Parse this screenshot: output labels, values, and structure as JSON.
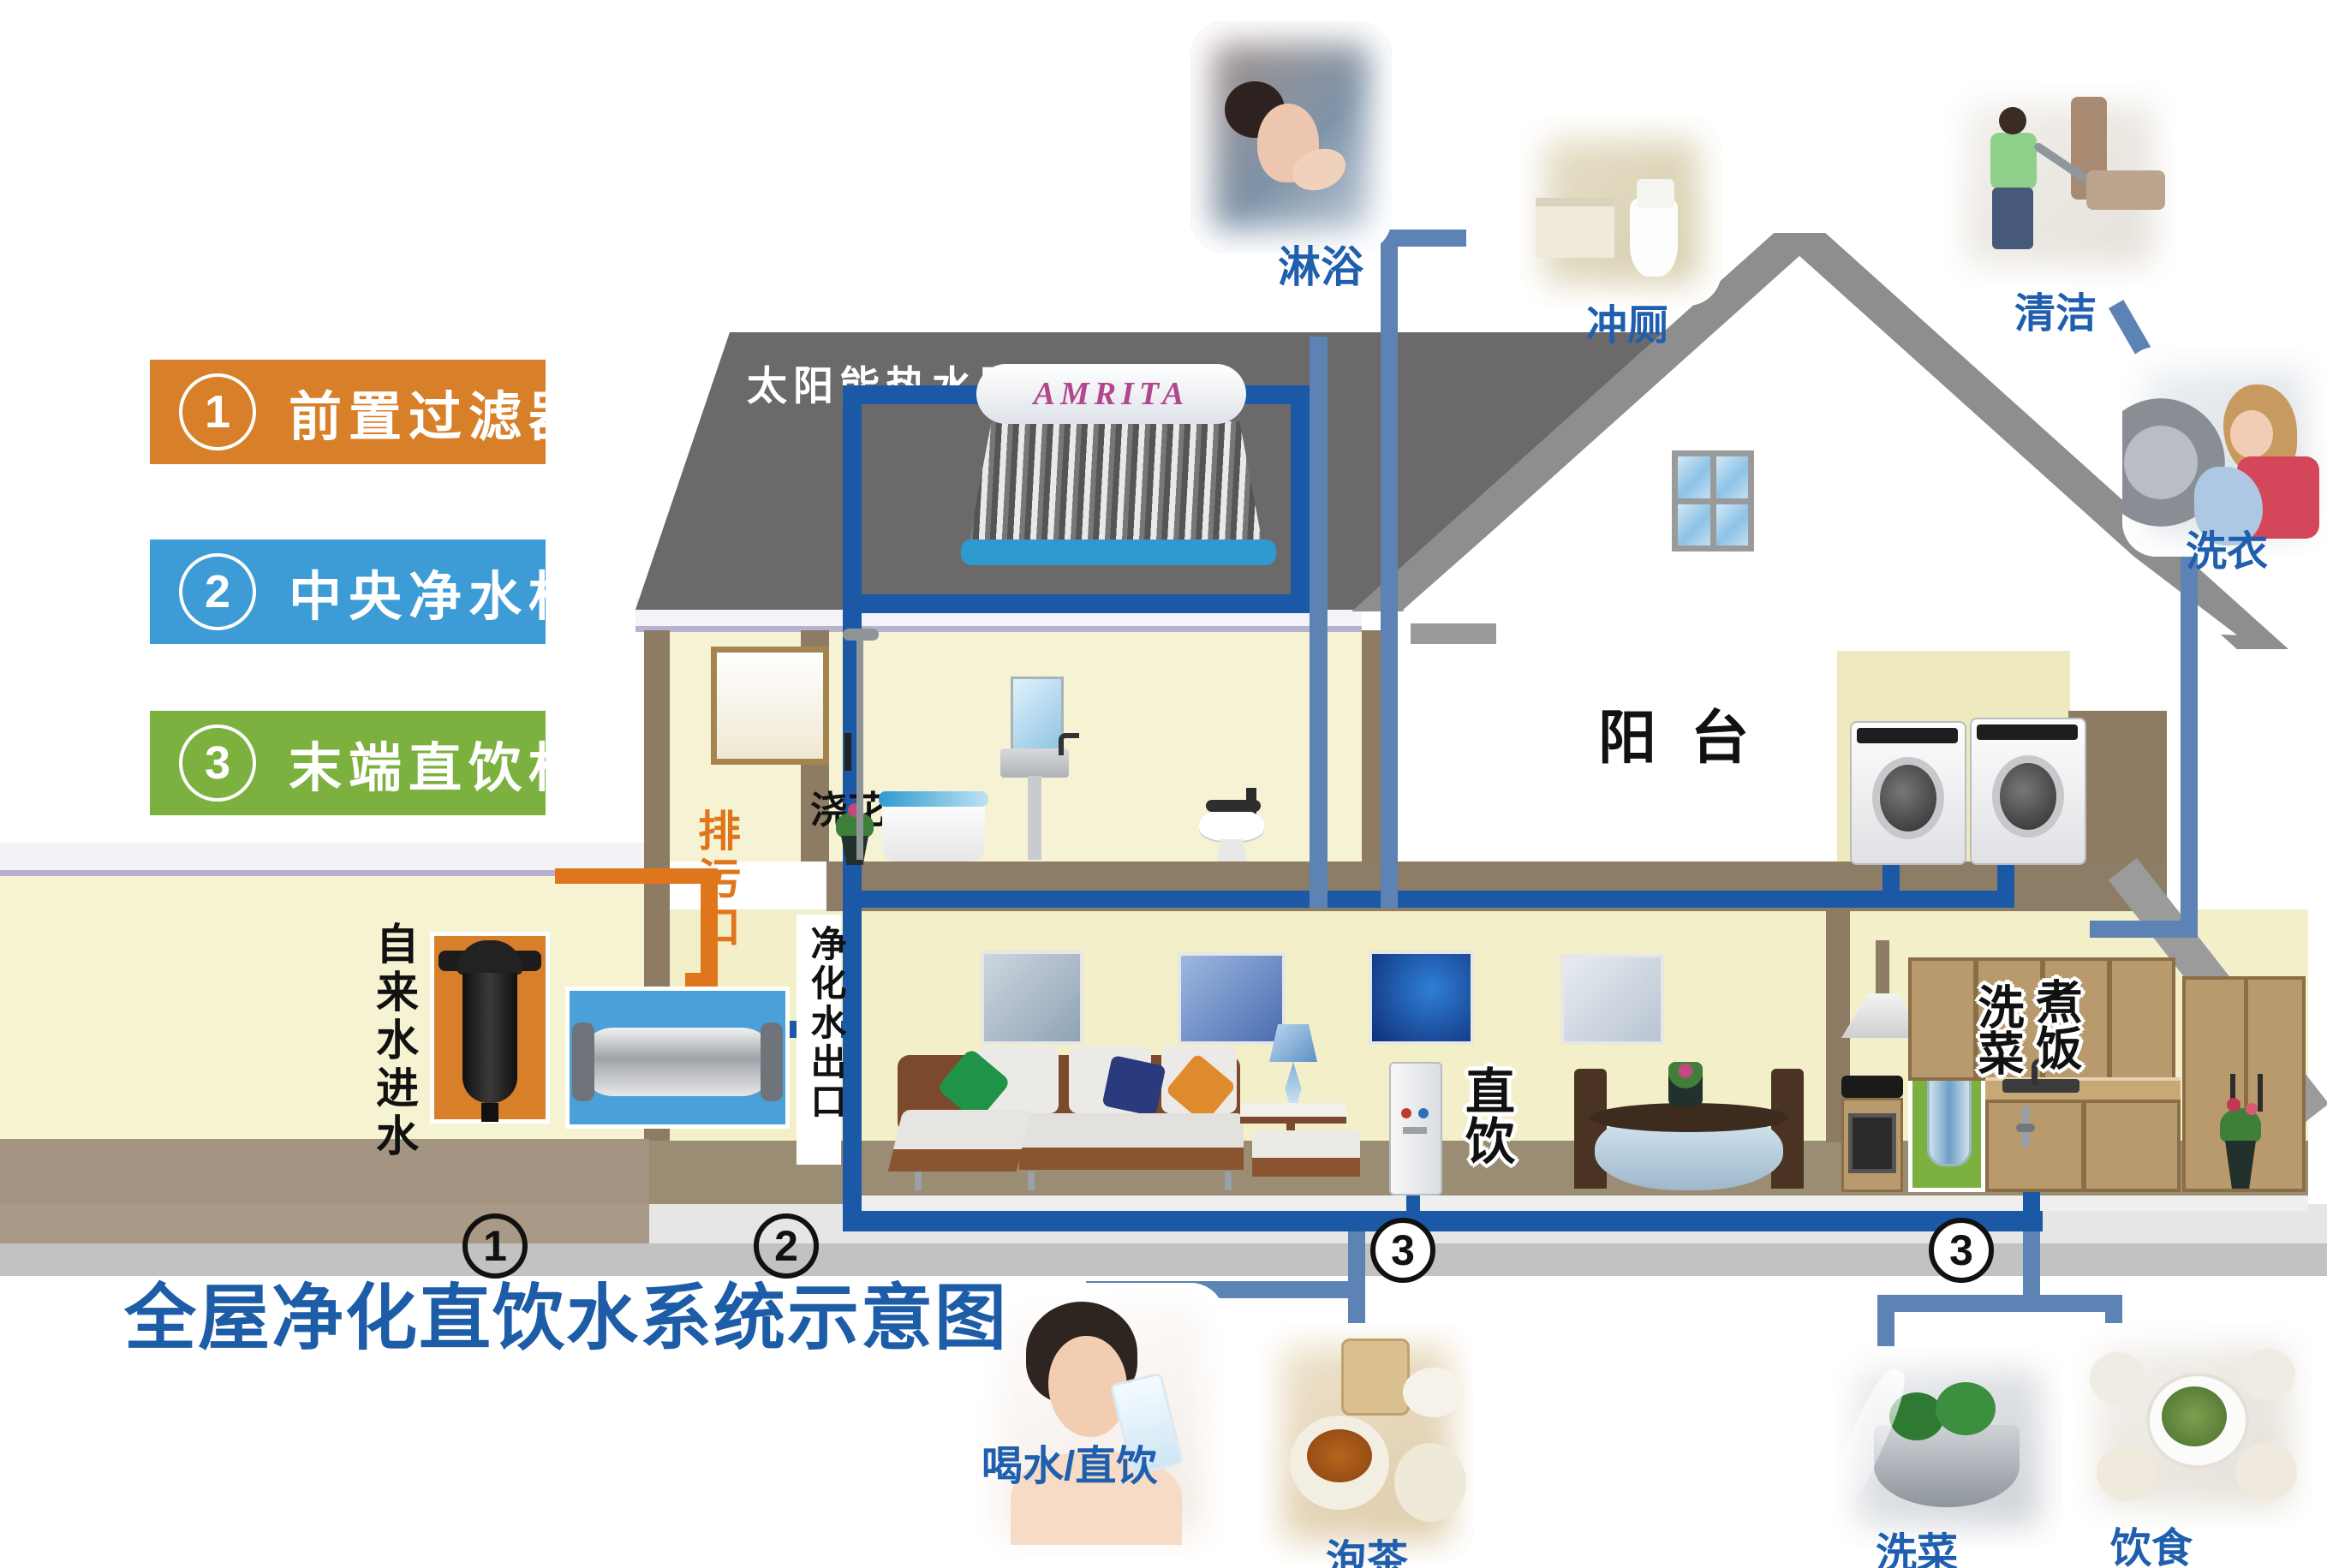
{
  "title": "全屋净化直饮水系统示意图",
  "legend": {
    "items": [
      {
        "num": "1",
        "label": "前置过滤器"
      },
      {
        "num": "2",
        "label": "中央净水机"
      },
      {
        "num": "3",
        "label": "末端直饮机"
      }
    ]
  },
  "roof": {
    "heater_label": "太阳能热水器",
    "heater_brand": "AMRITA"
  },
  "rooms": {
    "balcony": "阳台"
  },
  "annotations": {
    "watering": "浇花",
    "drain_outlet": "排污口",
    "tap_water_inlet": "自来水进水",
    "purified_outlet": "净化水出口",
    "direct_drink": "直饮",
    "wash_veg_kitchen": "洗菜",
    "cook_rice": "煮饭"
  },
  "usages": {
    "shower": "淋浴",
    "flush_toilet": "冲厕",
    "cleaning": "清洁",
    "laundry": "洗衣",
    "drinking": "喝水/直饮",
    "tea": "泡茶",
    "wash_vegetables": "洗菜",
    "food": "饮食"
  },
  "markers": {
    "m1": "1",
    "m2": "2",
    "m3_living": "3",
    "m3_kitchen": "3"
  },
  "colors": {
    "pipe_main": "#1b59a6",
    "pipe_branch": "#5d83b4",
    "pipe_drain": "#e0761c",
    "legend_orange": "#d87f2a",
    "legend_blue": "#3d9bd5",
    "legend_green": "#7cb13f",
    "label_blue": "#1f5fae",
    "title_blue": "#1d5da8"
  }
}
